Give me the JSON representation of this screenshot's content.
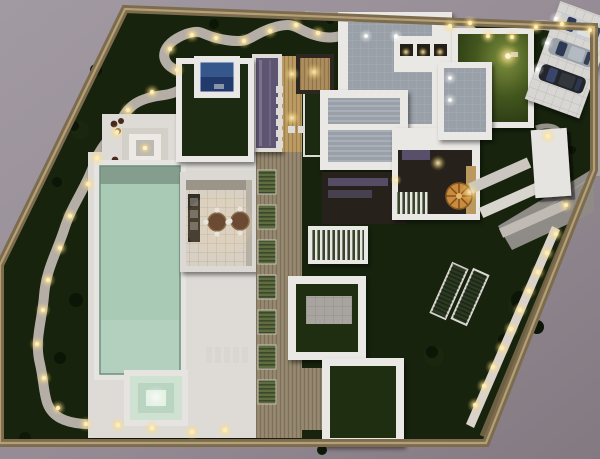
{
  "meta": {
    "description": "Night-time aerial 3D render of a modern villa site plan: walled garden lot, long swimming pool with spa, fire-pit lounge, dining terrace, flat white roofs with grey panels, timber walkway, spiral stair, lawn courtyards, carport with three cars, winding illuminated garden path",
    "visible_text": "none"
  },
  "palette": {
    "surround": "#998f98",
    "surround_dark": "#847a83",
    "street": "#aaa0a7",
    "sidewalk": "#b2a9af",
    "wall_tan": "#7d6b4d",
    "wall_top": "#b3a077",
    "garden": "#17230d",
    "bush": "#0c1506",
    "path": "#b4aea7",
    "deck_white": "#dedbd6",
    "roof_white": "#eae8e4",
    "roof_gray": "#99a0a8",
    "pool_water": "#a9cab5",
    "spa_ring_outer": "#cfe2d2",
    "spa_ring_mid": "#b9d4c1",
    "spa_center": "#e2f0e2",
    "wood_deck": "#93856c",
    "wood_warm": "#b9995f",
    "louver_green": "#5d6d40",
    "slat_dark": "#39442c",
    "glass_purple": "#5e5573",
    "solar_blue": "#35578c",
    "solar_blue_dark": "#22396b",
    "stair_orange": "#c98b3d",
    "concrete_pad": "#a8a5a0",
    "driveway": "#8f8c87",
    "gravel_band": "#cbc6c0",
    "lit_wall": "#d9d3cc",
    "interior_dark": "#26211a",
    "cabinet_dark": "#332e28",
    "furniture_dark": "#47291c",
    "table_brown": "#6b4a33",
    "car_silver": "#c9cdd3",
    "car_gray": "#9aa1a9",
    "car_black": "#22262b",
    "car_glass": "#2e3a55",
    "light_warm": "#ffe3a1"
  },
  "scene": {
    "objects": [
      "boundary-wall",
      "winding-garden-path",
      "path-lights",
      "swimming-pool",
      "spa",
      "fire-pit",
      "lounge-chairs",
      "dining-terrace",
      "dining-tables",
      "timber-deck-walkway",
      "louver-planters",
      "purple-skylight",
      "solar-skylight",
      "green-roof",
      "gray-roof-panels",
      "clerestory-windows",
      "courtyard-lawns",
      "concrete-pad",
      "louvered-pergola",
      "spiral-staircase",
      "entry-canopy",
      "driveway",
      "gravel-bands",
      "perimeter-light-wall",
      "garden-planters",
      "stepping-stones",
      "lawn-lamp",
      "carport",
      "cars",
      "street-surround"
    ]
  }
}
